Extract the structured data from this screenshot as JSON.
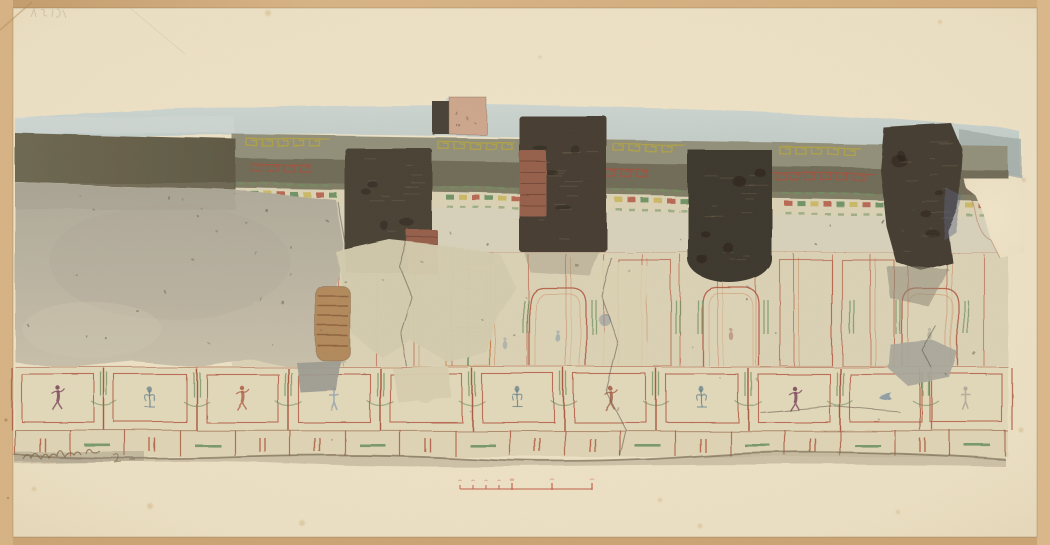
{
  "artwork": {
    "description": "Watercolor and pencil elevation of a fragmentary ancient Roman fresco wall: grey upper wash, olive ceiling bands with meander ornament, four dark brick niches, plain damaged plaster at left, and a lower zone of red-outlined panels containing small dancing figures, plants and birds above a dado; red drawn scale bar below.",
    "inscriptions": {
      "top_left_pencil": "faint illegible pencil numeral",
      "bottom_left_signature": "illegible artist inscription in brown ink"
    }
  },
  "palette": {
    "mount_tan": "#D4AF7E",
    "paper_cream": "#EDE1C5",
    "sky_wash": "#C3CDCA",
    "band_olive": "#6F6C59",
    "band_light": "#92907A",
    "niche_dark": "#463E31",
    "brick_red": "#96614B",
    "plaster_grey": "#B6B1A1",
    "panel_red": "#B35C44",
    "garland_green": "#6F9260",
    "meander_yellow": "#B4A544",
    "scale_red": "#C2604A"
  },
  "scene": {
    "meanders": {
      "band1": {
        "color": "#B4A544",
        "segments": [
          {
            "x": 246,
            "w": 84
          },
          {
            "x": 438,
            "w": 76
          },
          {
            "x": 614,
            "w": 72
          },
          {
            "x": 780,
            "w": 80
          }
        ]
      },
      "band2": {
        "color": "#A6523F",
        "segments": [
          {
            "x": 252,
            "w": 60
          },
          {
            "x": 558,
            "w": 92
          },
          {
            "x": 744,
            "w": 46
          },
          {
            "x": 790,
            "w": 84
          }
        ]
      },
      "green_rows": {
        "color": "#6F9260",
        "segments": [
          {
            "x": 238,
            "w": 96
          },
          {
            "x": 438,
            "w": 76
          },
          {
            "x": 614,
            "w": 70
          },
          {
            "x": 782,
            "w": 92
          }
        ]
      }
    },
    "cornice": {
      "step": 13,
      "y_base": 191,
      "slope": 0.017,
      "colors": [
        "#B15744",
        "#5E8A58",
        "#C8B55A"
      ],
      "green": "#6F9260"
    },
    "decor": {
      "red_lines": {
        "x0": 338,
        "x1": 1000,
        "step": 38,
        "y0": 254,
        "y1": 366,
        "color": "#BF6A4F"
      },
      "arch_panels": [
        558,
        731,
        930
      ],
      "rect_panels": [
        645,
        806,
        868
      ],
      "green_pairs": [
        524,
        592,
        676,
        698,
        764,
        850,
        896,
        964
      ],
      "candelabrum": {
        "x": 468,
        "stem_color": "#5E8A58",
        "frame_color": "#C8823F",
        "frames": [
          [
            444,
            226,
            48,
            38
          ],
          [
            452,
            270,
            34,
            58
          ],
          [
            446,
            332,
            44,
            34
          ]
        ]
      },
      "faint_marks": [
        {
          "x": 558,
          "y": 338,
          "color": "#7A8FA6"
        },
        {
          "x": 731,
          "y": 336,
          "color": "#A66A55"
        },
        {
          "x": 930,
          "y": 336,
          "color": "#9A9488"
        },
        {
          "x": 505,
          "y": 345,
          "color": "#8C96A0"
        }
      ]
    },
    "niches": [
      {
        "shape": "rect",
        "x": 345,
        "y": 148,
        "w": 87,
        "h": 124,
        "fill": "#4A4236",
        "brick": {
          "x": 407,
          "y": 230,
          "w": 31,
          "h": 44
        }
      },
      {
        "shape": "rect",
        "x": 519,
        "y": 116,
        "w": 88,
        "h": 136,
        "fill": "#463E32",
        "brick": {
          "x": 519,
          "y": 150,
          "w": 27,
          "h": 66
        }
      },
      {
        "shape": "arch",
        "x": 688,
        "y": 150,
        "w": 84,
        "h": 137,
        "fill": "#3E372D"
      },
      {
        "shape": "blob",
        "fill": "#453D31",
        "pts": "884,128 952,124 962,148 958,210 948,232 952,262 920,270 896,262 886,226 880,170"
      }
    ],
    "figure_row": {
      "panels": [
        {
          "cx": 58,
          "figure": "dancer",
          "color": "#7D4A5C"
        },
        {
          "cx": 150,
          "figure": "floral",
          "color": "#5F7D88"
        },
        {
          "cx": 242,
          "figure": "dancer",
          "color": "#B06348"
        },
        {
          "cx": 334,
          "figure": "generic",
          "color": "#7A8FA6"
        },
        {
          "cx": 426,
          "figure": "blank",
          "color": "#D8CEB0"
        },
        {
          "cx": 518,
          "figure": "floral",
          "color": "#5F7D88"
        },
        {
          "cx": 610,
          "figure": "dancer",
          "color": "#A5604A"
        },
        {
          "cx": 702,
          "figure": "floral",
          "color": "#5F7D88"
        },
        {
          "cx": 794,
          "figure": "dancer",
          "color": "#7D4A5C"
        },
        {
          "cx": 886,
          "figure": "bird",
          "color": "#6E87A0"
        },
        {
          "cx": 966,
          "figure": "generic",
          "color": "#9A9488"
        }
      ]
    },
    "dado": {
      "block_w": 55,
      "pattern": [
        "bars",
        "dash",
        "bars",
        "dash",
        "bars",
        "bars",
        "dash",
        "bars",
        "dash",
        "bars",
        "bars",
        "dash",
        "bars",
        "dash",
        "bars",
        "dash",
        "bars",
        "dash"
      ]
    },
    "cracks": [
      "408,236 399,266 412,298 401,334 406,366",
      "612,258 602,296 618,342 606,392 626,430 620,456",
      "936,326 922,350 932,368",
      "760,412 830,406 900,412",
      "338,202 346,246"
    ],
    "speckle_regions": [
      {
        "x": 25,
        "y": 192,
        "w": 300,
        "h": 160,
        "n": 24,
        "color": "#6B665A"
      },
      {
        "x": 340,
        "y": 252,
        "w": 640,
        "h": 105,
        "n": 14,
        "color": "#6F6A5E"
      },
      {
        "x": 240,
        "y": 205,
        "w": 740,
        "h": 42,
        "n": 12,
        "color": "#5E5A4E"
      },
      {
        "x": 20,
        "y": 370,
        "w": 970,
        "h": 78,
        "n": 10,
        "color": "#7A7262"
      },
      {
        "x": 452,
        "y": 100,
        "w": 32,
        "h": 30,
        "n": 5,
        "color": "#6B5B49"
      }
    ],
    "scale_bar": {
      "x": 460,
      "y": 489,
      "length": 132,
      "sub_ticks": [
        0,
        13,
        26,
        39,
        52
      ],
      "major_ticks": [
        52,
        92,
        132
      ],
      "color": "#C2604A"
    },
    "foxing": [
      {
        "x": 268,
        "y": 13,
        "r": 3
      },
      {
        "x": 940,
        "y": 22,
        "r": 2
      },
      {
        "x": 150,
        "y": 506,
        "r": 3
      },
      {
        "x": 302,
        "y": 523,
        "r": 3
      },
      {
        "x": 700,
        "y": 526,
        "r": 2.5
      },
      {
        "x": 898,
        "y": 512,
        "r": 2
      },
      {
        "x": 1021,
        "y": 430,
        "r": 2.5
      },
      {
        "x": 1024,
        "y": 180,
        "r": 2
      },
      {
        "x": 34,
        "y": 489,
        "r": 2
      },
      {
        "x": 540,
        "y": 57,
        "r": 1.5
      },
      {
        "x": 660,
        "y": 500,
        "r": 2
      }
    ]
  }
}
